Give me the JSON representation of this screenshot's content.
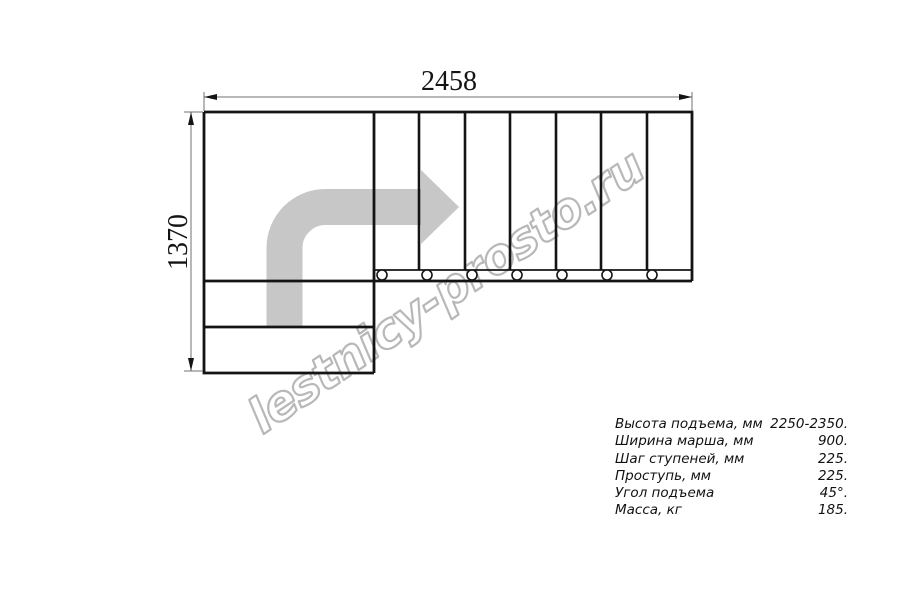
{
  "drawing": {
    "width_label": "2458",
    "height_label": "1370"
  },
  "watermark": {
    "text": "lestnicy-prosto.ru",
    "color": "#b8b8b8"
  },
  "specs": {
    "rows": [
      {
        "label": "Высота подъема, мм",
        "value": "2250-2350."
      },
      {
        "label": "Ширина марша, мм",
        "value": "900."
      },
      {
        "label": "Шаг ступеней, мм",
        "value": "225."
      },
      {
        "label": "Проступь, мм",
        "value": "225."
      },
      {
        "label": "Угол подъема",
        "value": "45°."
      },
      {
        "label": "Масса, кг",
        "value": "185."
      }
    ]
  },
  "colors": {
    "background": "#ffffff",
    "outline": "#141414",
    "dimension_line": "#707070",
    "arrow_fill": "#c7c7c7",
    "watermark_stroke": "#b8b8b8"
  }
}
